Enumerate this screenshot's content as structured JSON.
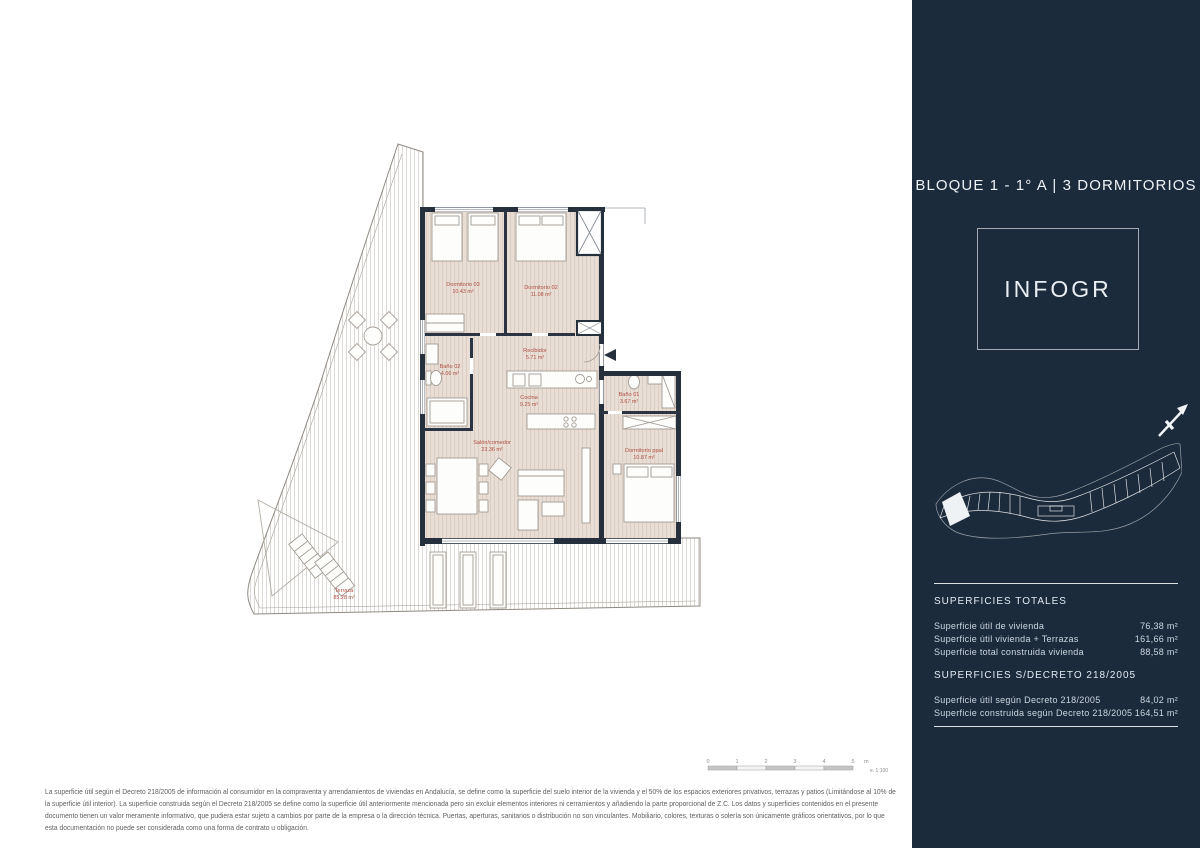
{
  "colors": {
    "sidebar_bg": "#1c2b3b",
    "wall": "#26303c",
    "room_label": "#ae4f44",
    "floor_base": "#e9ded6"
  },
  "sidebar": {
    "title": "BLOQUE 1 - 1° A | 3 DORMITORIOS",
    "logo_text": "INFOGR",
    "sections": {
      "totales": {
        "heading": "SUPERFICIES TOTALES",
        "rows": [
          {
            "label": "Superficie útil de vivienda",
            "value": "76,38 m²"
          },
          {
            "label": "Superficie útil vivienda + Terrazas",
            "value": "161,66 m²"
          },
          {
            "label": "Superficie total construida vivienda",
            "value": "88,58 m²"
          }
        ]
      },
      "decreto": {
        "heading": "SUPERFICIES S/DECRETO 218/2005",
        "rows": [
          {
            "label": "Superficie útil según Decreto 218/2005",
            "value": "84,02 m²"
          },
          {
            "label": "Superficie construida según Decreto 218/2005",
            "value": "164,51 m²"
          }
        ]
      }
    }
  },
  "floorplan": {
    "rooms": [
      {
        "name": "Dormitorio 03",
        "area": "10.43 m²"
      },
      {
        "name": "Dormitorio 02",
        "area": "11.08 m²"
      },
      {
        "name": "Recibidor",
        "area": "5.71 m²"
      },
      {
        "name": "Baño 02",
        "area": "4.06 m²"
      },
      {
        "name": "Cocina",
        "area": "9.25 m²"
      },
      {
        "name": "Baño 01",
        "area": "3.67 m²"
      },
      {
        "name": "Salón/comedor",
        "area": "23.36 m²"
      },
      {
        "name": "Dormitorio ppal",
        "area": "10.87 m²"
      },
      {
        "name": "Terraza",
        "area": "85.28 m²"
      }
    ]
  },
  "scalebar": {
    "ticks": [
      "0",
      "1",
      "2",
      "3",
      "4",
      "5"
    ],
    "unit": "m",
    "scale_note": "e. 1:100"
  },
  "disclaimer": {
    "lines": [
      "La superficie útil según el Decreto 218/2005 de información al consumidor en la compraventa y arrendamientos de viviendas en Andalucía, se define como la superficie del suelo interior de la vivienda y el 50% de los espacios exteriores privativos, terrazas y patios (Limitándose al 10% de",
      "la superficie útil interior). La superficie construida según el Decreto 218/2005 se define como la superficie útil anteriormente mencionada pero sin excluir elementos interiores ni cerramientos y añadiendo la parte proporcional de Z.C. Los datos y superficies contenidos en el presente",
      "documento tienen un valor meramente informativo, que pudiera estar sujeto a cambios por parte de la empresa o la dirección técnica. Puertas, aperturas, sanitarios o distribución no son vinculantes. Mobiliario, colores, texturas o solería son únicamente gráficos orientativos, por lo que",
      "esta documentación no puede ser considerada como una forma de contrato u obligación."
    ]
  }
}
